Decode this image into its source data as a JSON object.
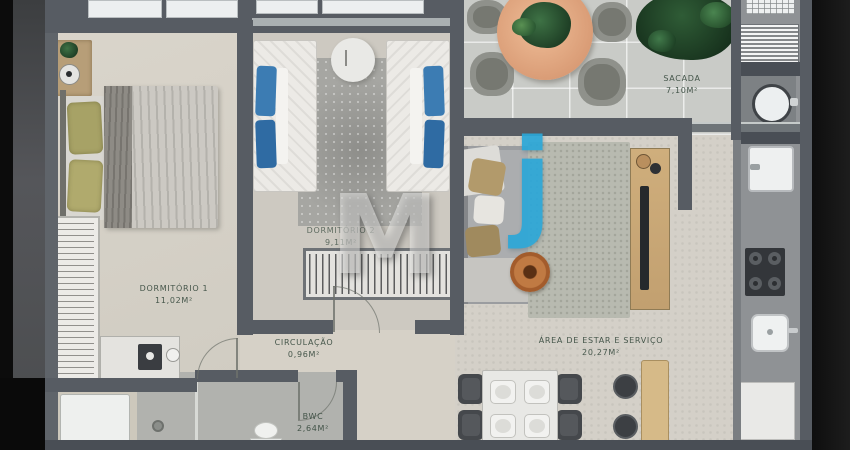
{
  "watermark": {
    "mark_m": "M",
    "mark_j": "j",
    "blue_color": "#2ba7d8"
  },
  "rooms": {
    "dormitorio1": {
      "name": "DORMITÓRIO 1",
      "area": "11,02m²"
    },
    "dormitorio2": {
      "name": "DORMITÓRIO 2",
      "area": "9,11m²"
    },
    "sacada": {
      "name": "SACADA",
      "area": "7,10m²"
    },
    "circulacao": {
      "name": "CIRCULAÇÃO",
      "area": "0,96m²"
    },
    "estar_servico": {
      "name": "ÁREA DE ESTAR E SERVIÇO",
      "area": "20,27m²"
    },
    "bwc": {
      "name": "BWC",
      "area": "2,64m²"
    }
  },
  "palette": {
    "wall": "#575c63",
    "floor_bedroom": "#d6d1c7",
    "floor_balcony": "#c9cbc7",
    "floor_bwc": "#b1b2ae",
    "pillow_blue": "#3c7cb3",
    "wood": "#c9a876",
    "label_green": "#3a4c40"
  }
}
